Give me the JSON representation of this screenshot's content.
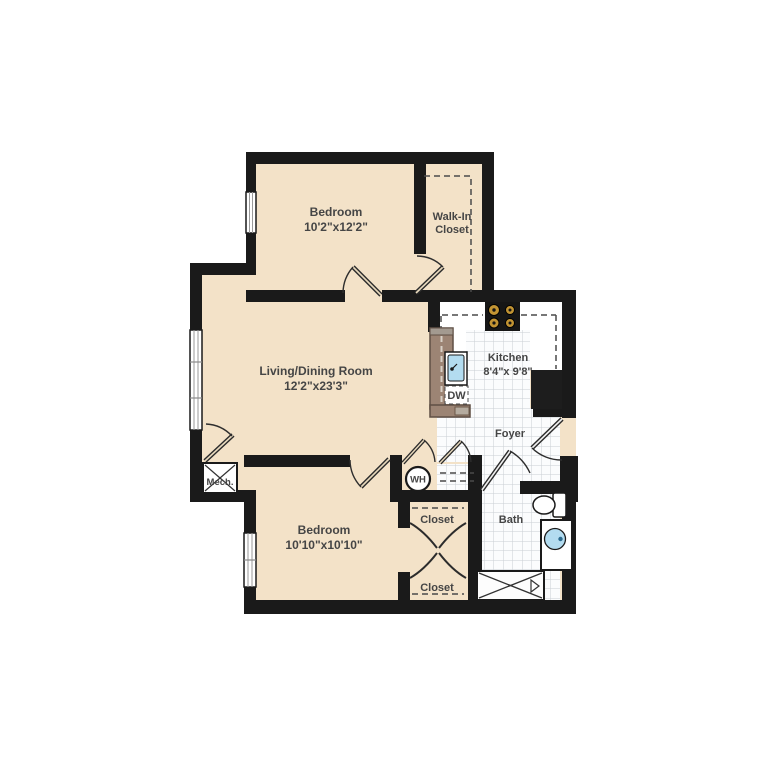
{
  "plan_title": "Two Bedroom Apartment Floor Plan",
  "rooms": {
    "bedroom1": {
      "name": "Bedroom",
      "dims": "10'2\"x12'2\""
    },
    "walk_in_closet": {
      "line1": "Walk-In",
      "line2": "Closet"
    },
    "living": {
      "name": "Living/Dining Room",
      "dims": "12'2\"x23'3\""
    },
    "kitchen": {
      "name": "Kitchen",
      "dims": "8'4\"x 9'8\""
    },
    "foyer": {
      "name": "Foyer"
    },
    "bedroom2": {
      "name": "Bedroom",
      "dims": "10'10\"x10'10\""
    },
    "bath": {
      "name": "Bath"
    },
    "closet_upper": {
      "name": "Closet"
    },
    "closet_lower": {
      "name": "Closet"
    },
    "mech": {
      "name": "Mech."
    }
  },
  "fixtures": {
    "water_heater": "WH",
    "dishwasher": "DW"
  },
  "colors": {
    "wall": "#1a1a1a",
    "floor_beige": "#f3e2c8",
    "tile_line": "#c9ced4",
    "counter_brown": "#9c8474",
    "sink_blue": "#b3dcf0",
    "burner_gold": "#c29433"
  }
}
